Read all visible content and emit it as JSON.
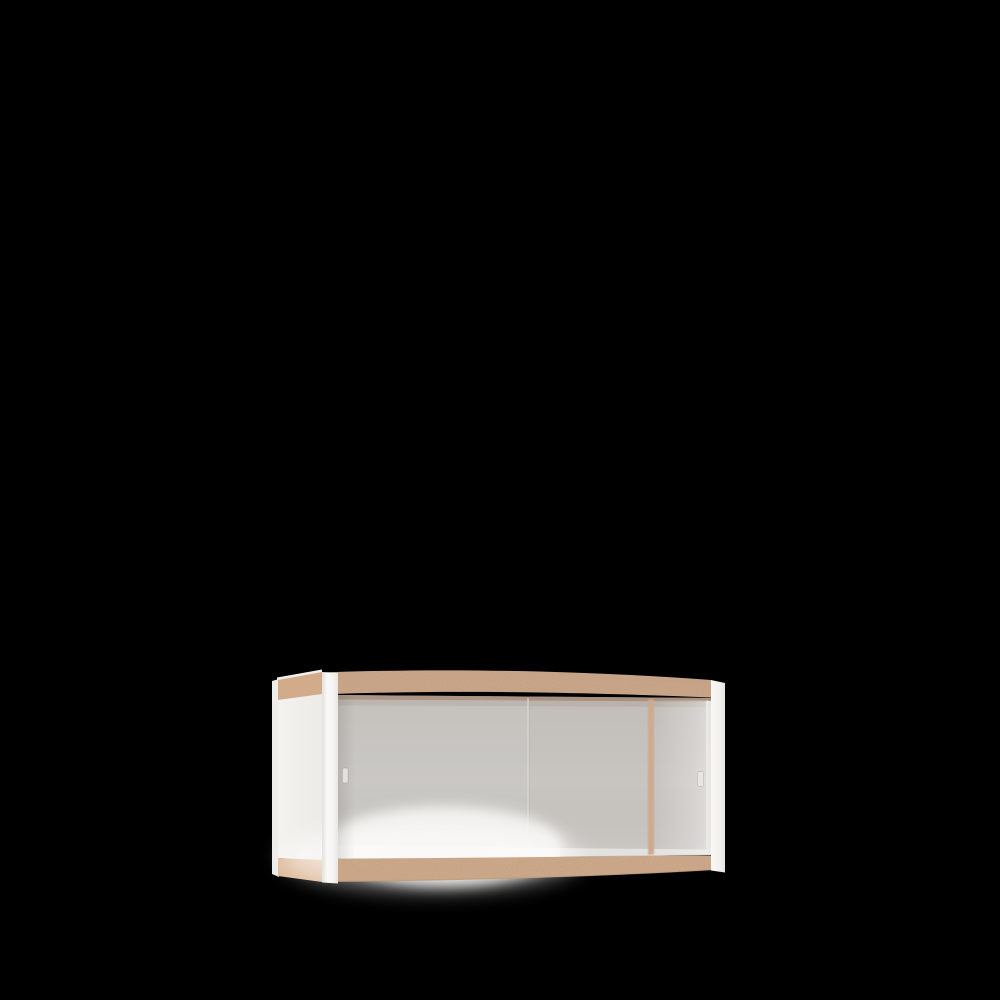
{
  "scene": {
    "description": "3D product render of a wall-mounted cabinet with two sliding frosted-glass doors, white frame posts and side panel, exposed tan wood edge bands top and bottom, centered low on a solid black background",
    "object_label": "wall-cabinet-with-sliding-glass-doors"
  },
  "colors": {
    "background": "#000000",
    "wood_edge_top": "#d9b394",
    "wood_edge_top_dark": "#c7a283",
    "wood_edge_bottom": "#dcb695",
    "wood_side_top": "#d2ab8a",
    "wood_side_bottom": "#deba9c",
    "wood_divider": "#cfa98c",
    "frame_white": "#f6f5f2",
    "side_panel_white": "#f2f0ed",
    "back_edge_white": "#eeece8",
    "top_surface_white": "#f1efeb",
    "glass": "#c8c5c1",
    "glass_light_band": "#d7d4d1",
    "glass_glow": "#f7f6f3",
    "inner_shelf_light": "#f0eeea",
    "shadow_under_top": "#a18570",
    "handle_left": "#e3e1dd",
    "handle_right": "#e9e7e3",
    "bottom_edge_shadow": "#b08f72"
  }
}
